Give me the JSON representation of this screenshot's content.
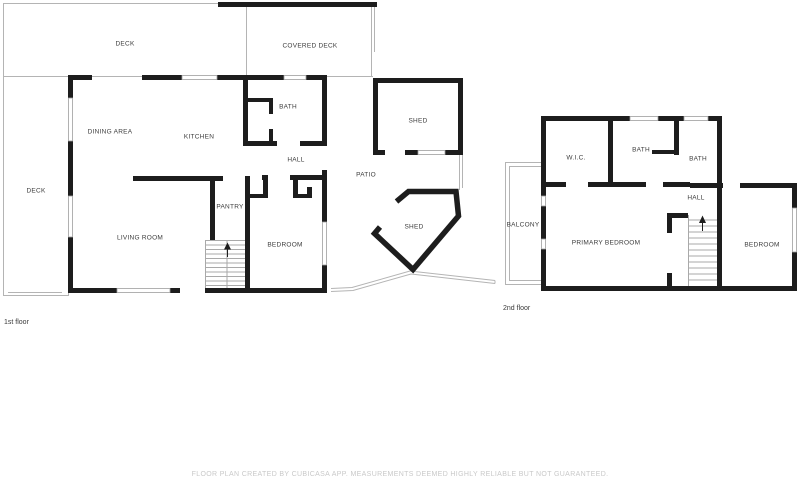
{
  "colors": {
    "wall": "#1d1d1d",
    "thin_outline": "#b4b4b4",
    "stair_line": "#a9a9a9",
    "label_text": "#3c3c3c",
    "footer_text": "#c9c9c9",
    "background": "#ffffff"
  },
  "first_floor": {
    "caption": "1st floor",
    "rooms": [
      {
        "id": "deck-top",
        "label": "DECK"
      },
      {
        "id": "covered-deck",
        "label": "COVERED DECK"
      },
      {
        "id": "deck-left",
        "label": "DECK"
      },
      {
        "id": "dining-area",
        "label": "DINING AREA"
      },
      {
        "id": "kitchen",
        "label": "KITCHEN"
      },
      {
        "id": "bath",
        "label": "BATH"
      },
      {
        "id": "hall",
        "label": "HALL"
      },
      {
        "id": "pantry",
        "label": "PANTRY"
      },
      {
        "id": "living-room",
        "label": "LIVING ROOM"
      },
      {
        "id": "bedroom",
        "label": "BEDROOM"
      },
      {
        "id": "patio",
        "label": "PATIO"
      },
      {
        "id": "shed-upper",
        "label": "SHED"
      },
      {
        "id": "shed-lower",
        "label": "SHED"
      }
    ]
  },
  "second_floor": {
    "caption": "2nd floor",
    "rooms": [
      {
        "id": "wic",
        "label": "W.I.C."
      },
      {
        "id": "bath-middle",
        "label": "BATH"
      },
      {
        "id": "bath-right",
        "label": "BATH"
      },
      {
        "id": "balcony",
        "label": "BALCONY"
      },
      {
        "id": "hall",
        "label": "HALL"
      },
      {
        "id": "primary-bedroom",
        "label": "PRIMARY BEDROOM"
      },
      {
        "id": "bedroom",
        "label": "BEDROOM"
      }
    ]
  },
  "footer": {
    "disclaimer": "FLOOR PLAN CREATED BY CUBICASA APP. MEASUREMENTS DEEMED HIGHLY RELIABLE BUT NOT GUARANTEED."
  }
}
